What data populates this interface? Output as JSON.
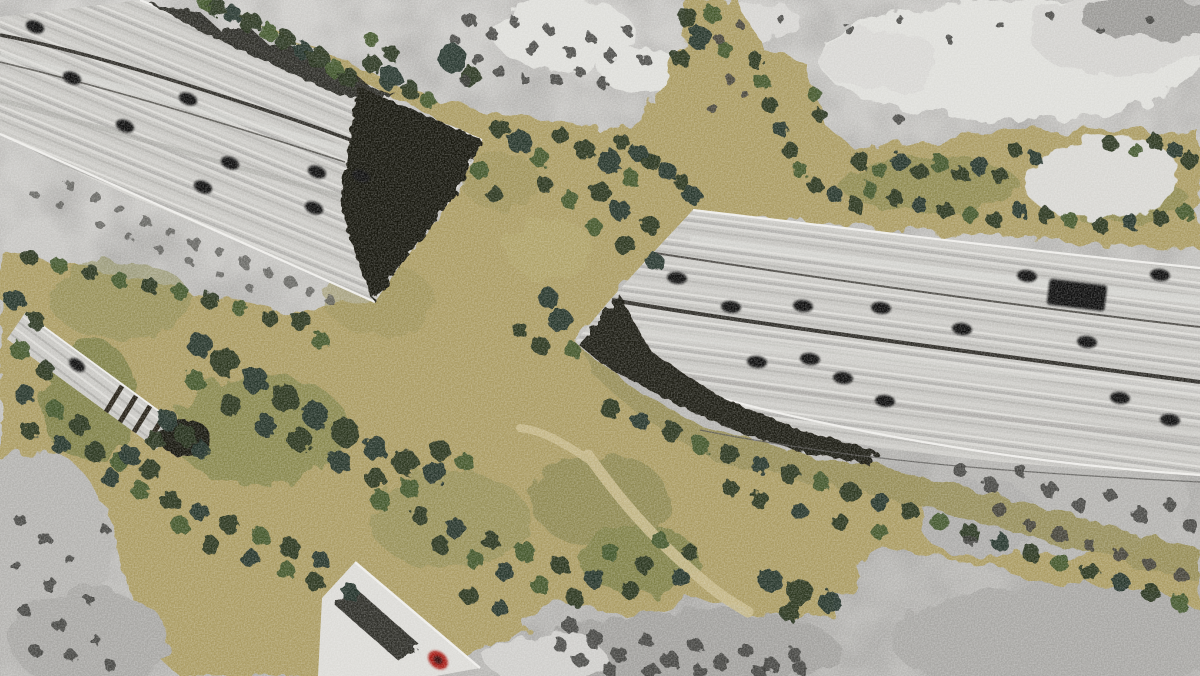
{
  "scene": {
    "type": "aerial-photograph",
    "subject": "vegetated wildlife overpass crossing a multi-lane freeway",
    "style": "color habitat corridor composited over grayscale terrain photo",
    "freeway_angle_left_deg": 22,
    "freeway_angle_right_deg": 7,
    "ramp_angle_deg": 37,
    "frontage_road_angle_deg": 41
  },
  "palette": {
    "pavement": "#c2c1bd",
    "pavement_light": "#dcdbd7",
    "pavement_dark": "#a9a8a4",
    "lane_white": "#eeedea",
    "median": "#2e2c27",
    "portal_dark": "#191309",
    "shadow_dark": "#1d1b14",
    "tan": "#ab9c63",
    "tan_light": "#c6b883",
    "olive": "#8b8a52",
    "moss": "#5f6e35",
    "strip_olive": "#968e58",
    "tree_dark": "#28331d",
    "tree_teal": "#203029",
    "tree_mid": "#41552b",
    "tree_light": "#6d8242",
    "gray_terrain": "#c0bfbc",
    "rock_light": "#dededa",
    "gray_mid": "#9b9a97",
    "gray_dark": "#555451",
    "gray_tree": "#393936",
    "vehicle": "#0e0e0c",
    "red_car": "#a81e17",
    "trail": "#c7b98a",
    "clearing": "#d8d7d3",
    "base_top": "#cfcecb",
    "base_bottom": "#b8b7b4"
  },
  "counts": {
    "vehicles_left_freeway": 9,
    "vehicles_right_freeway": 14,
    "trucks_right_freeway": 1,
    "vehicles_ramp": 1,
    "vehicles_frontage_road": 1
  },
  "vehicles": {
    "left": [
      [
        35,
        27
      ],
      [
        72,
        78
      ],
      [
        125,
        126
      ],
      [
        188,
        99
      ],
      [
        230,
        163
      ],
      [
        203,
        187
      ],
      [
        317,
        172
      ],
      [
        361,
        176
      ],
      [
        314,
        208
      ]
    ],
    "right": [
      [
        677,
        278
      ],
      [
        731,
        307
      ],
      [
        803,
        306
      ],
      [
        881,
        308
      ],
      [
        962,
        329
      ],
      [
        1027,
        276
      ],
      [
        1087,
        342
      ],
      [
        1160,
        275
      ],
      [
        757,
        362
      ],
      [
        810,
        359
      ],
      [
        843,
        378
      ],
      [
        885,
        401
      ],
      [
        1120,
        398
      ],
      [
        1170,
        420
      ]
    ],
    "truck": {
      "x": 1048,
      "y": 282,
      "w": 58,
      "h": 26,
      "rot": 7
    },
    "ramp": [
      [
        77,
        365
      ]
    ],
    "frontage_red_car": {
      "x": 438,
      "y": 660,
      "rx": 11,
      "ry": 8,
      "rot": 40
    }
  },
  "trees": [
    [
      215,
      6,
      10,
      "d"
    ],
    [
      232,
      14,
      9,
      "t"
    ],
    [
      250,
      22,
      11,
      "d"
    ],
    [
      268,
      32,
      9,
      "m"
    ],
    [
      285,
      40,
      10,
      "d"
    ],
    [
      302,
      50,
      9,
      "t"
    ],
    [
      318,
      58,
      11,
      "d"
    ],
    [
      334,
      68,
      9,
      "m"
    ],
    [
      348,
      78,
      10,
      "d"
    ],
    [
      205,
      2,
      8,
      "m"
    ],
    [
      372,
      64,
      9,
      "d"
    ],
    [
      390,
      78,
      12,
      "t"
    ],
    [
      410,
      90,
      9,
      "d"
    ],
    [
      428,
      100,
      8,
      "m"
    ],
    [
      372,
      40,
      7,
      "m"
    ],
    [
      390,
      52,
      8,
      "d"
    ],
    [
      688,
      18,
      10,
      "d"
    ],
    [
      700,
      38,
      12,
      "t"
    ],
    [
      712,
      14,
      9,
      "m"
    ],
    [
      680,
      58,
      9,
      "d"
    ],
    [
      725,
      50,
      8,
      "m"
    ],
    [
      452,
      58,
      14,
      "t"
    ],
    [
      470,
      76,
      10,
      "d"
    ],
    [
      500,
      128,
      10,
      "d"
    ],
    [
      520,
      142,
      12,
      "t"
    ],
    [
      540,
      158,
      9,
      "m"
    ],
    [
      560,
      135,
      8,
      "d"
    ],
    [
      585,
      150,
      10,
      "d"
    ],
    [
      610,
      162,
      12,
      "t"
    ],
    [
      630,
      178,
      9,
      "m"
    ],
    [
      648,
      160,
      8,
      "d"
    ],
    [
      600,
      192,
      10,
      "d"
    ],
    [
      570,
      200,
      9,
      "m"
    ],
    [
      545,
      185,
      8,
      "d"
    ],
    [
      620,
      210,
      10,
      "t"
    ],
    [
      650,
      225,
      9,
      "d"
    ],
    [
      595,
      228,
      8,
      "m"
    ],
    [
      625,
      245,
      10,
      "d"
    ],
    [
      655,
      262,
      9,
      "t"
    ],
    [
      480,
      170,
      9,
      "m"
    ],
    [
      495,
      195,
      8,
      "d"
    ],
    [
      622,
      142,
      8,
      "d"
    ],
    [
      638,
      152,
      9,
      "t"
    ],
    [
      654,
      162,
      8,
      "d"
    ],
    [
      668,
      172,
      9,
      "t"
    ],
    [
      682,
      182,
      8,
      "d"
    ],
    [
      692,
      195,
      9,
      "t"
    ],
    [
      548,
      298,
      10,
      "t"
    ],
    [
      560,
      320,
      12,
      "t"
    ],
    [
      540,
      345,
      9,
      "d"
    ],
    [
      572,
      350,
      8,
      "m"
    ],
    [
      520,
      330,
      8,
      "d"
    ],
    [
      300,
      320,
      10,
      "d"
    ],
    [
      320,
      340,
      9,
      "m"
    ],
    [
      270,
      318,
      8,
      "d"
    ],
    [
      240,
      308,
      8,
      "m"
    ],
    [
      210,
      300,
      9,
      "d"
    ],
    [
      180,
      292,
      8,
      "m"
    ],
    [
      150,
      286,
      8,
      "d"
    ],
    [
      120,
      280,
      8,
      "m"
    ],
    [
      90,
      272,
      8,
      "d"
    ],
    [
      60,
      266,
      8,
      "m"
    ],
    [
      30,
      258,
      8,
      "d"
    ],
    [
      200,
      345,
      12,
      "t"
    ],
    [
      225,
      362,
      14,
      "d"
    ],
    [
      255,
      380,
      13,
      "t"
    ],
    [
      285,
      398,
      14,
      "d"
    ],
    [
      315,
      415,
      13,
      "t"
    ],
    [
      345,
      432,
      14,
      "d"
    ],
    [
      375,
      448,
      12,
      "t"
    ],
    [
      405,
      462,
      13,
      "d"
    ],
    [
      435,
      472,
      12,
      "t"
    ],
    [
      300,
      440,
      12,
      "d"
    ],
    [
      265,
      425,
      11,
      "t"
    ],
    [
      230,
      405,
      11,
      "d"
    ],
    [
      340,
      462,
      11,
      "t"
    ],
    [
      375,
      478,
      10,
      "d"
    ],
    [
      410,
      488,
      10,
      "m"
    ],
    [
      195,
      380,
      10,
      "m"
    ],
    [
      440,
      450,
      10,
      "d"
    ],
    [
      465,
      462,
      9,
      "m"
    ],
    [
      15,
      300,
      10,
      "t"
    ],
    [
      35,
      320,
      9,
      "d"
    ],
    [
      20,
      350,
      10,
      "m"
    ],
    [
      45,
      370,
      9,
      "d"
    ],
    [
      25,
      395,
      10,
      "t"
    ],
    [
      55,
      410,
      9,
      "m"
    ],
    [
      80,
      425,
      10,
      "d"
    ],
    [
      30,
      430,
      9,
      "d"
    ],
    [
      60,
      445,
      9,
      "t"
    ],
    [
      95,
      452,
      10,
      "d"
    ],
    [
      120,
      462,
      9,
      "m"
    ],
    [
      150,
      470,
      10,
      "d"
    ],
    [
      110,
      478,
      9,
      "t"
    ],
    [
      140,
      490,
      9,
      "m"
    ],
    [
      170,
      500,
      10,
      "d"
    ],
    [
      200,
      512,
      9,
      "t"
    ],
    [
      230,
      524,
      10,
      "d"
    ],
    [
      260,
      536,
      9,
      "m"
    ],
    [
      290,
      548,
      10,
      "d"
    ],
    [
      320,
      560,
      9,
      "t"
    ],
    [
      180,
      525,
      9,
      "m"
    ],
    [
      210,
      545,
      9,
      "d"
    ],
    [
      250,
      558,
      9,
      "t"
    ],
    [
      285,
      570,
      9,
      "m"
    ],
    [
      315,
      582,
      9,
      "d"
    ],
    [
      350,
      592,
      9,
      "t"
    ],
    [
      380,
      500,
      10,
      "m"
    ],
    [
      420,
      515,
      9,
      "d"
    ],
    [
      455,
      528,
      10,
      "t"
    ],
    [
      490,
      540,
      9,
      "d"
    ],
    [
      525,
      552,
      10,
      "m"
    ],
    [
      560,
      565,
      9,
      "d"
    ],
    [
      595,
      578,
      10,
      "t"
    ],
    [
      630,
      590,
      9,
      "d"
    ],
    [
      475,
      560,
      9,
      "m"
    ],
    [
      440,
      545,
      9,
      "d"
    ],
    [
      505,
      572,
      9,
      "t"
    ],
    [
      540,
      585,
      9,
      "m"
    ],
    [
      575,
      598,
      9,
      "d"
    ],
    [
      610,
      552,
      9,
      "m"
    ],
    [
      645,
      565,
      9,
      "d"
    ],
    [
      680,
      578,
      9,
      "t"
    ],
    [
      660,
      540,
      8,
      "m"
    ],
    [
      690,
      552,
      8,
      "d"
    ],
    [
      470,
      596,
      9,
      "d"
    ],
    [
      500,
      608,
      8,
      "t"
    ],
    [
      610,
      408,
      10,
      "d"
    ],
    [
      640,
      420,
      9,
      "t"
    ],
    [
      672,
      432,
      10,
      "d"
    ],
    [
      700,
      445,
      9,
      "m"
    ],
    [
      730,
      455,
      10,
      "d"
    ],
    [
      760,
      465,
      9,
      "t"
    ],
    [
      790,
      474,
      10,
      "d"
    ],
    [
      820,
      482,
      9,
      "m"
    ],
    [
      850,
      492,
      10,
      "d"
    ],
    [
      880,
      502,
      9,
      "t"
    ],
    [
      910,
      512,
      9,
      "d"
    ],
    [
      940,
      522,
      9,
      "m"
    ],
    [
      970,
      532,
      9,
      "d"
    ],
    [
      1000,
      542,
      9,
      "t"
    ],
    [
      1030,
      552,
      9,
      "d"
    ],
    [
      1060,
      562,
      9,
      "m"
    ],
    [
      1090,
      572,
      9,
      "d"
    ],
    [
      1120,
      582,
      9,
      "t"
    ],
    [
      1150,
      592,
      9,
      "d"
    ],
    [
      1180,
      602,
      9,
      "m"
    ],
    [
      760,
      500,
      9,
      "d"
    ],
    [
      800,
      512,
      8,
      "t"
    ],
    [
      840,
      522,
      8,
      "d"
    ],
    [
      880,
      532,
      8,
      "m"
    ],
    [
      730,
      488,
      8,
      "d"
    ],
    [
      770,
      580,
      12,
      "t"
    ],
    [
      800,
      592,
      13,
      "d"
    ],
    [
      830,
      602,
      11,
      "t"
    ],
    [
      790,
      612,
      10,
      "d"
    ],
    [
      860,
      160,
      9,
      "d"
    ],
    [
      880,
      170,
      8,
      "m"
    ],
    [
      900,
      162,
      9,
      "t"
    ],
    [
      920,
      172,
      8,
      "d"
    ],
    [
      940,
      164,
      9,
      "m"
    ],
    [
      960,
      174,
      8,
      "d"
    ],
    [
      980,
      166,
      9,
      "t"
    ],
    [
      1000,
      176,
      8,
      "d"
    ],
    [
      870,
      190,
      8,
      "m"
    ],
    [
      895,
      198,
      8,
      "d"
    ],
    [
      920,
      205,
      8,
      "t"
    ],
    [
      945,
      210,
      8,
      "d"
    ],
    [
      970,
      215,
      8,
      "m"
    ],
    [
      995,
      220,
      8,
      "d"
    ],
    [
      1020,
      210,
      8,
      "t"
    ],
    [
      1045,
      215,
      8,
      "d"
    ],
    [
      1070,
      220,
      8,
      "m"
    ],
    [
      1100,
      225,
      8,
      "d"
    ],
    [
      1130,
      222,
      8,
      "t"
    ],
    [
      1160,
      218,
      8,
      "d"
    ],
    [
      1185,
      212,
      8,
      "m"
    ],
    [
      1190,
      160,
      9,
      "d"
    ],
    [
      1175,
      150,
      8,
      "t"
    ],
    [
      1155,
      142,
      8,
      "d"
    ],
    [
      1135,
      150,
      7,
      "m"
    ],
    [
      1110,
      144,
      8,
      "d"
    ],
    [
      1015,
      150,
      7,
      "d"
    ],
    [
      1035,
      158,
      7,
      "t"
    ],
    [
      855,
      205,
      8,
      "d"
    ],
    [
      835,
      195,
      8,
      "t"
    ],
    [
      815,
      185,
      8,
      "d"
    ],
    [
      800,
      170,
      8,
      "m"
    ],
    [
      790,
      150,
      8,
      "d"
    ],
    [
      780,
      128,
      8,
      "t"
    ],
    [
      770,
      105,
      8,
      "d"
    ],
    [
      762,
      82,
      8,
      "m"
    ],
    [
      755,
      60,
      8,
      "d"
    ],
    [
      815,
      95,
      7,
      "m"
    ],
    [
      820,
      115,
      7,
      "d"
    ],
    [
      168,
      420,
      10,
      "t"
    ],
    [
      185,
      435,
      11,
      "d"
    ],
    [
      200,
      450,
      9,
      "t"
    ],
    [
      155,
      440,
      9,
      "d"
    ],
    [
      130,
      455,
      10,
      "t"
    ]
  ],
  "gray_trees": [
    [
      470,
      20,
      7
    ],
    [
      492,
      34,
      6
    ],
    [
      515,
      22,
      5
    ],
    [
      532,
      48,
      7
    ],
    [
      550,
      30,
      5
    ],
    [
      570,
      52,
      6
    ],
    [
      590,
      38,
      5
    ],
    [
      610,
      55,
      6
    ],
    [
      628,
      30,
      5
    ],
    [
      645,
      60,
      6
    ],
    [
      478,
      60,
      6
    ],
    [
      500,
      72,
      6
    ],
    [
      525,
      80,
      5
    ],
    [
      556,
      80,
      6
    ],
    [
      580,
      72,
      5
    ],
    [
      602,
      82,
      6
    ],
    [
      455,
      40,
      5
    ],
    [
      465,
      80,
      5
    ],
    [
      720,
      40,
      5
    ],
    [
      740,
      25,
      4
    ],
    [
      780,
      18,
      4
    ],
    [
      850,
      30,
      5
    ],
    [
      900,
      20,
      4
    ],
    [
      950,
      40,
      4
    ],
    [
      1000,
      25,
      4
    ],
    [
      1050,
      15,
      4
    ],
    [
      1100,
      30,
      4
    ],
    [
      1150,
      20,
      4
    ],
    [
      730,
      80,
      5
    ],
    [
      712,
      108,
      5
    ],
    [
      745,
      95,
      4
    ],
    [
      900,
      120,
      5
    ],
    [
      960,
      470,
      7
    ],
    [
      990,
      485,
      8
    ],
    [
      1020,
      470,
      6
    ],
    [
      1050,
      490,
      8
    ],
    [
      1080,
      505,
      7
    ],
    [
      1110,
      495,
      6
    ],
    [
      1140,
      515,
      8
    ],
    [
      1170,
      505,
      6
    ],
    [
      1190,
      525,
      7
    ],
    [
      1000,
      510,
      7
    ],
    [
      1030,
      525,
      6
    ],
    [
      1060,
      535,
      8
    ],
    [
      1090,
      545,
      6
    ],
    [
      1120,
      555,
      7
    ],
    [
      1150,
      565,
      6
    ],
    [
      1180,
      575,
      7
    ],
    [
      970,
      540,
      6
    ],
    [
      570,
      625,
      8
    ],
    [
      595,
      640,
      9
    ],
    [
      620,
      655,
      8
    ],
    [
      645,
      640,
      7
    ],
    [
      670,
      660,
      9
    ],
    [
      695,
      645,
      7
    ],
    [
      720,
      662,
      8
    ],
    [
      745,
      650,
      7
    ],
    [
      770,
      665,
      8
    ],
    [
      795,
      655,
      7
    ],
    [
      580,
      660,
      7
    ],
    [
      610,
      670,
      7
    ],
    [
      650,
      670,
      8
    ],
    [
      700,
      672,
      7
    ],
    [
      760,
      672,
      7
    ],
    [
      800,
      668,
      7
    ],
    [
      560,
      645,
      7
    ],
    [
      20,
      520,
      6
    ],
    [
      45,
      540,
      7
    ],
    [
      15,
      565,
      5
    ],
    [
      50,
      585,
      7
    ],
    [
      25,
      610,
      6
    ],
    [
      60,
      625,
      7
    ],
    [
      35,
      650,
      6
    ],
    [
      70,
      655,
      6
    ],
    [
      95,
      640,
      5
    ],
    [
      110,
      665,
      6
    ],
    [
      90,
      600,
      5
    ],
    [
      70,
      560,
      5
    ],
    [
      105,
      530,
      5
    ]
  ],
  "embankment_specks": [
    [
      70,
      185,
      5
    ],
    [
      95,
      198,
      6
    ],
    [
      120,
      210,
      5
    ],
    [
      145,
      222,
      6
    ],
    [
      170,
      232,
      5
    ],
    [
      195,
      243,
      6
    ],
    [
      220,
      252,
      5
    ],
    [
      245,
      262,
      6
    ],
    [
      268,
      272,
      5
    ],
    [
      290,
      282,
      6
    ],
    [
      310,
      292,
      5
    ],
    [
      330,
      300,
      5
    ],
    [
      100,
      225,
      4
    ],
    [
      130,
      238,
      4
    ],
    [
      160,
      250,
      4
    ],
    [
      190,
      262,
      4
    ],
    [
      220,
      275,
      4
    ],
    [
      250,
      288,
      4
    ],
    [
      60,
      205,
      4
    ],
    [
      35,
      195,
      4
    ]
  ],
  "trails": {
    "main": "M588,455 C620,500 650,535 700,578 C720,596 738,606 748,612",
    "branch": "M592,462 C560,440 540,430 520,428"
  }
}
